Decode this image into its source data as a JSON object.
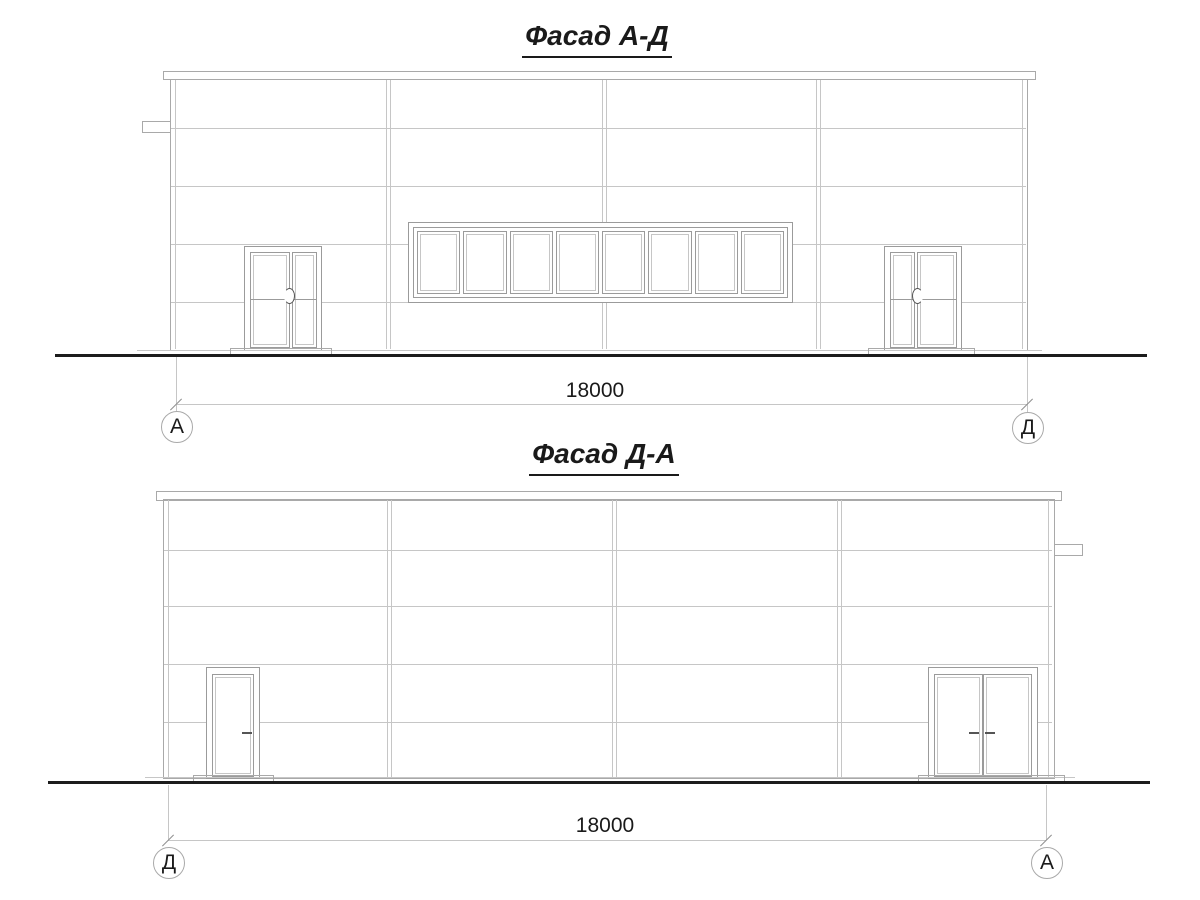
{
  "colors": {
    "line_main": "#a9a9a9",
    "line_light": "#c6c6c6",
    "line_door": "#9b9b9b",
    "tick": "#8f8f8f",
    "handle": "#555555",
    "ground": "#1c1c1c",
    "text": "#1a1a1a"
  },
  "facade_top": {
    "title": "Фасад А-Д",
    "dimension": "18000",
    "axis_left": "А",
    "axis_right": "Д"
  },
  "facade_bottom": {
    "title": "Фасад Д-А",
    "dimension": "18000",
    "axis_left": "Д",
    "axis_right": "А"
  }
}
